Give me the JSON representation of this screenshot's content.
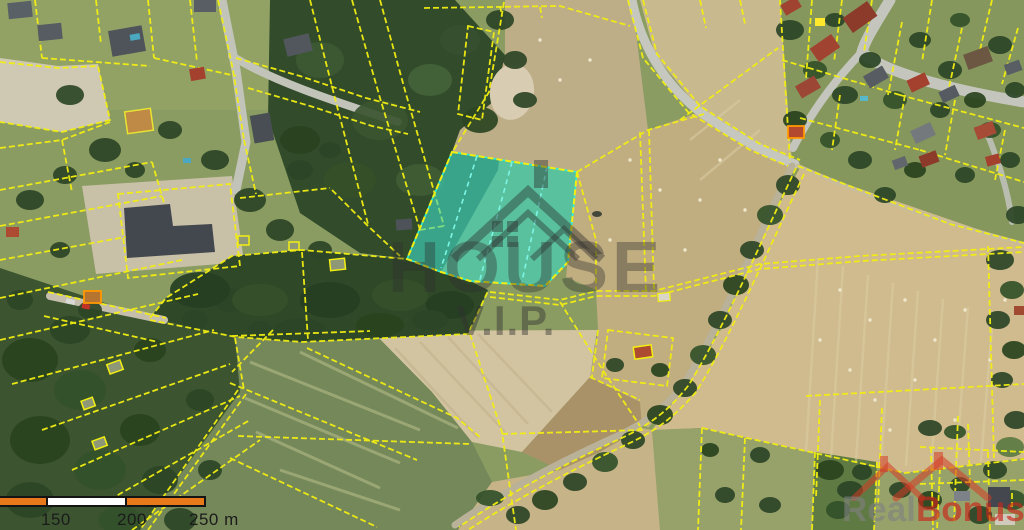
{
  "map": {
    "type": "aerial-cadastral-map",
    "parcel_line_color": "#f2ee12",
    "special_outline_color": "#ff9800",
    "highlighted_parcel": {
      "fill": "#3bd9c4",
      "stroke": "#2cf0da",
      "points": "452,152 577,172 568,262 545,286 470,281 441,272 407,259",
      "subdivision_lines": {
        "0": "477,156 441,268",
        "1": "512,162 479,283",
        "2": "547,167 521,286"
      }
    }
  },
  "watermarks": {
    "center": {
      "title": "HOUSE",
      "subtitle": "V.I.P."
    },
    "corner": {
      "part1": "Real",
      "part2": "Bonus"
    }
  },
  "scale_bar": {
    "labels": [
      "150",
      "200",
      "250 m"
    ],
    "segment_color_a": "#e8791b",
    "segment_color_b": "#ffffff",
    "border_color": "#141414"
  }
}
